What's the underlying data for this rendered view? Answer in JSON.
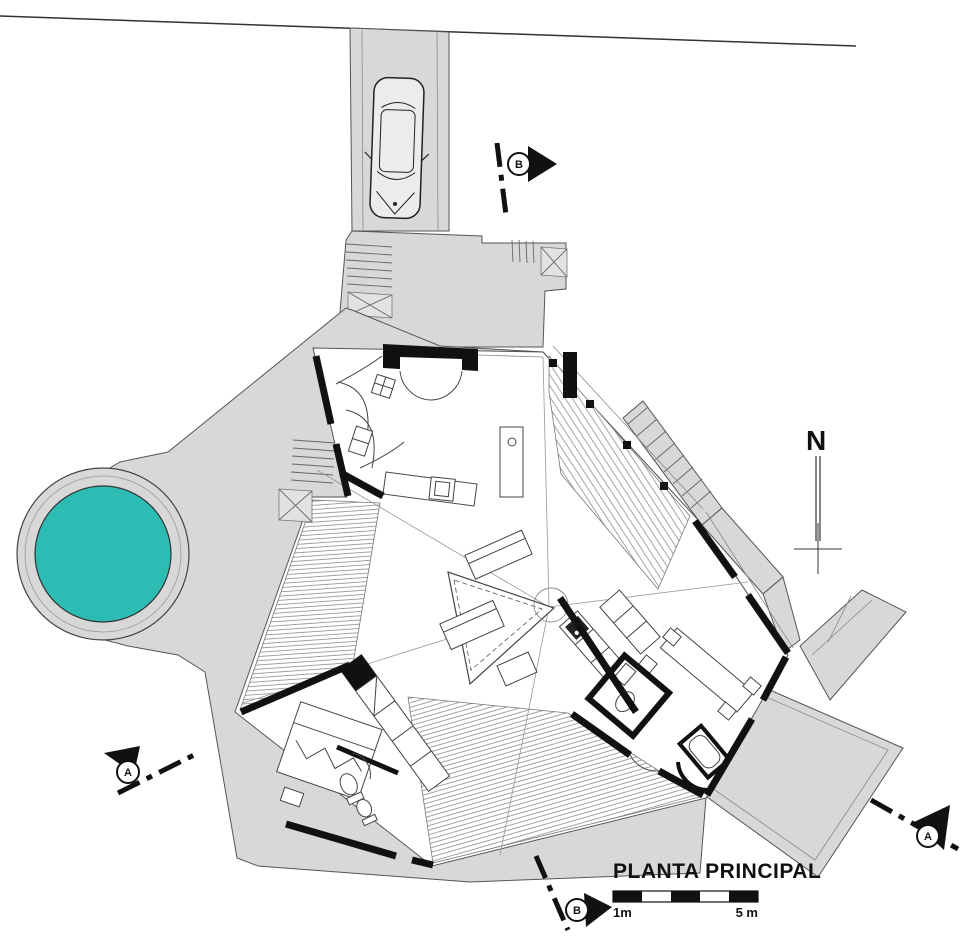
{
  "plan": {
    "title": "PLANTA PRINCIPAL",
    "north": {
      "label": "N"
    },
    "scale_bar": {
      "start_label": "1m",
      "end_label": "5 m"
    },
    "section_markers": {
      "top": {
        "label": "B"
      },
      "bottom": {
        "label": "B"
      },
      "left": {
        "label": "A"
      },
      "right": {
        "label": "A"
      }
    },
    "colors": {
      "pool_water": "#2cbcb4",
      "paving": "#d8d8d8",
      "wall": "#111111",
      "background": "#ffffff"
    }
  }
}
